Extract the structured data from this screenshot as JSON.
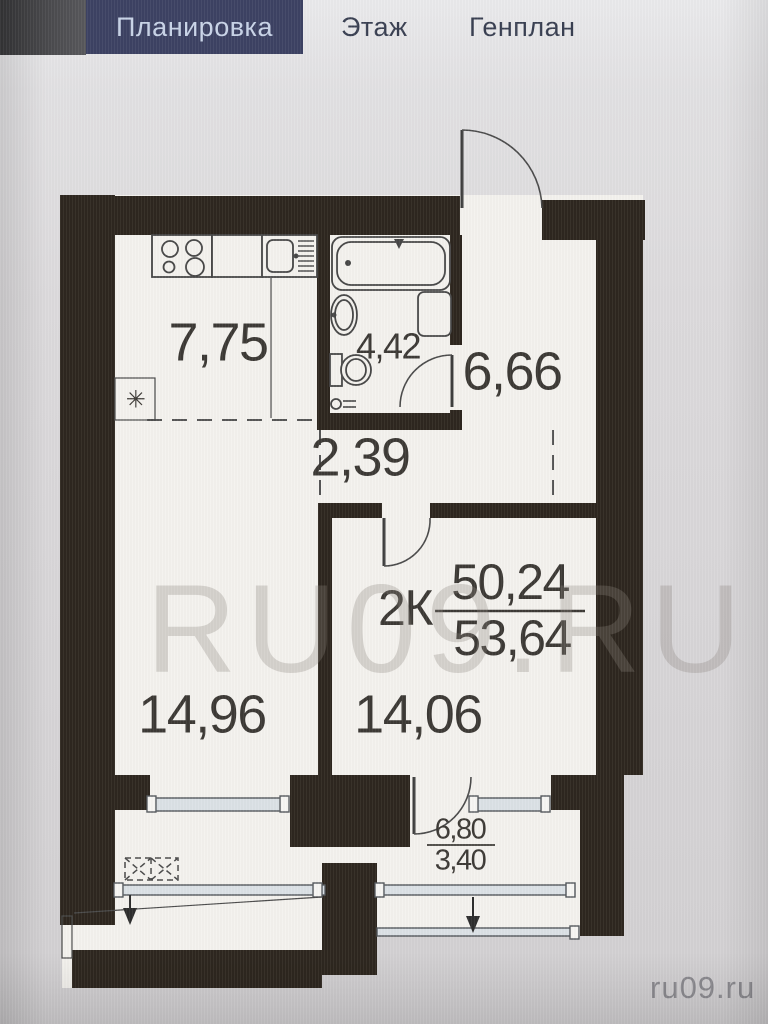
{
  "tabs": [
    {
      "label": "Планировка",
      "active": true
    },
    {
      "label": "Этаж",
      "active": false
    },
    {
      "label": "Генплан",
      "active": false
    }
  ],
  "watermark": {
    "text": "RU09.RU"
  },
  "site_label": "ru09.ru",
  "plan": {
    "rooms": [
      {
        "name": "kitchen",
        "area": "7,75"
      },
      {
        "name": "bathroom",
        "area": "4,42"
      },
      {
        "name": "hallway",
        "area": "6,66"
      },
      {
        "name": "corridor",
        "area": "2,39"
      },
      {
        "name": "living-room",
        "area": "14,96"
      },
      {
        "name": "bedroom",
        "area": "14,06"
      }
    ],
    "loggia": {
      "area_full": "6,80",
      "area_reduced": "3,40"
    },
    "apartment_label": {
      "type": "2К",
      "upper_area": "50,24",
      "lower_area": "53,64"
    },
    "symbols": {
      "shaft_mark": "✳"
    }
  },
  "colors": {
    "wall": "#2e271f",
    "floor": "#f4f2ee",
    "active_tab_bg": "#3d4263",
    "active_tab_text": "#c9d4e8",
    "tab_text": "#3a4052",
    "glazing": "#dbe1e6",
    "watermark": "rgba(138,132,126,0.30)"
  }
}
